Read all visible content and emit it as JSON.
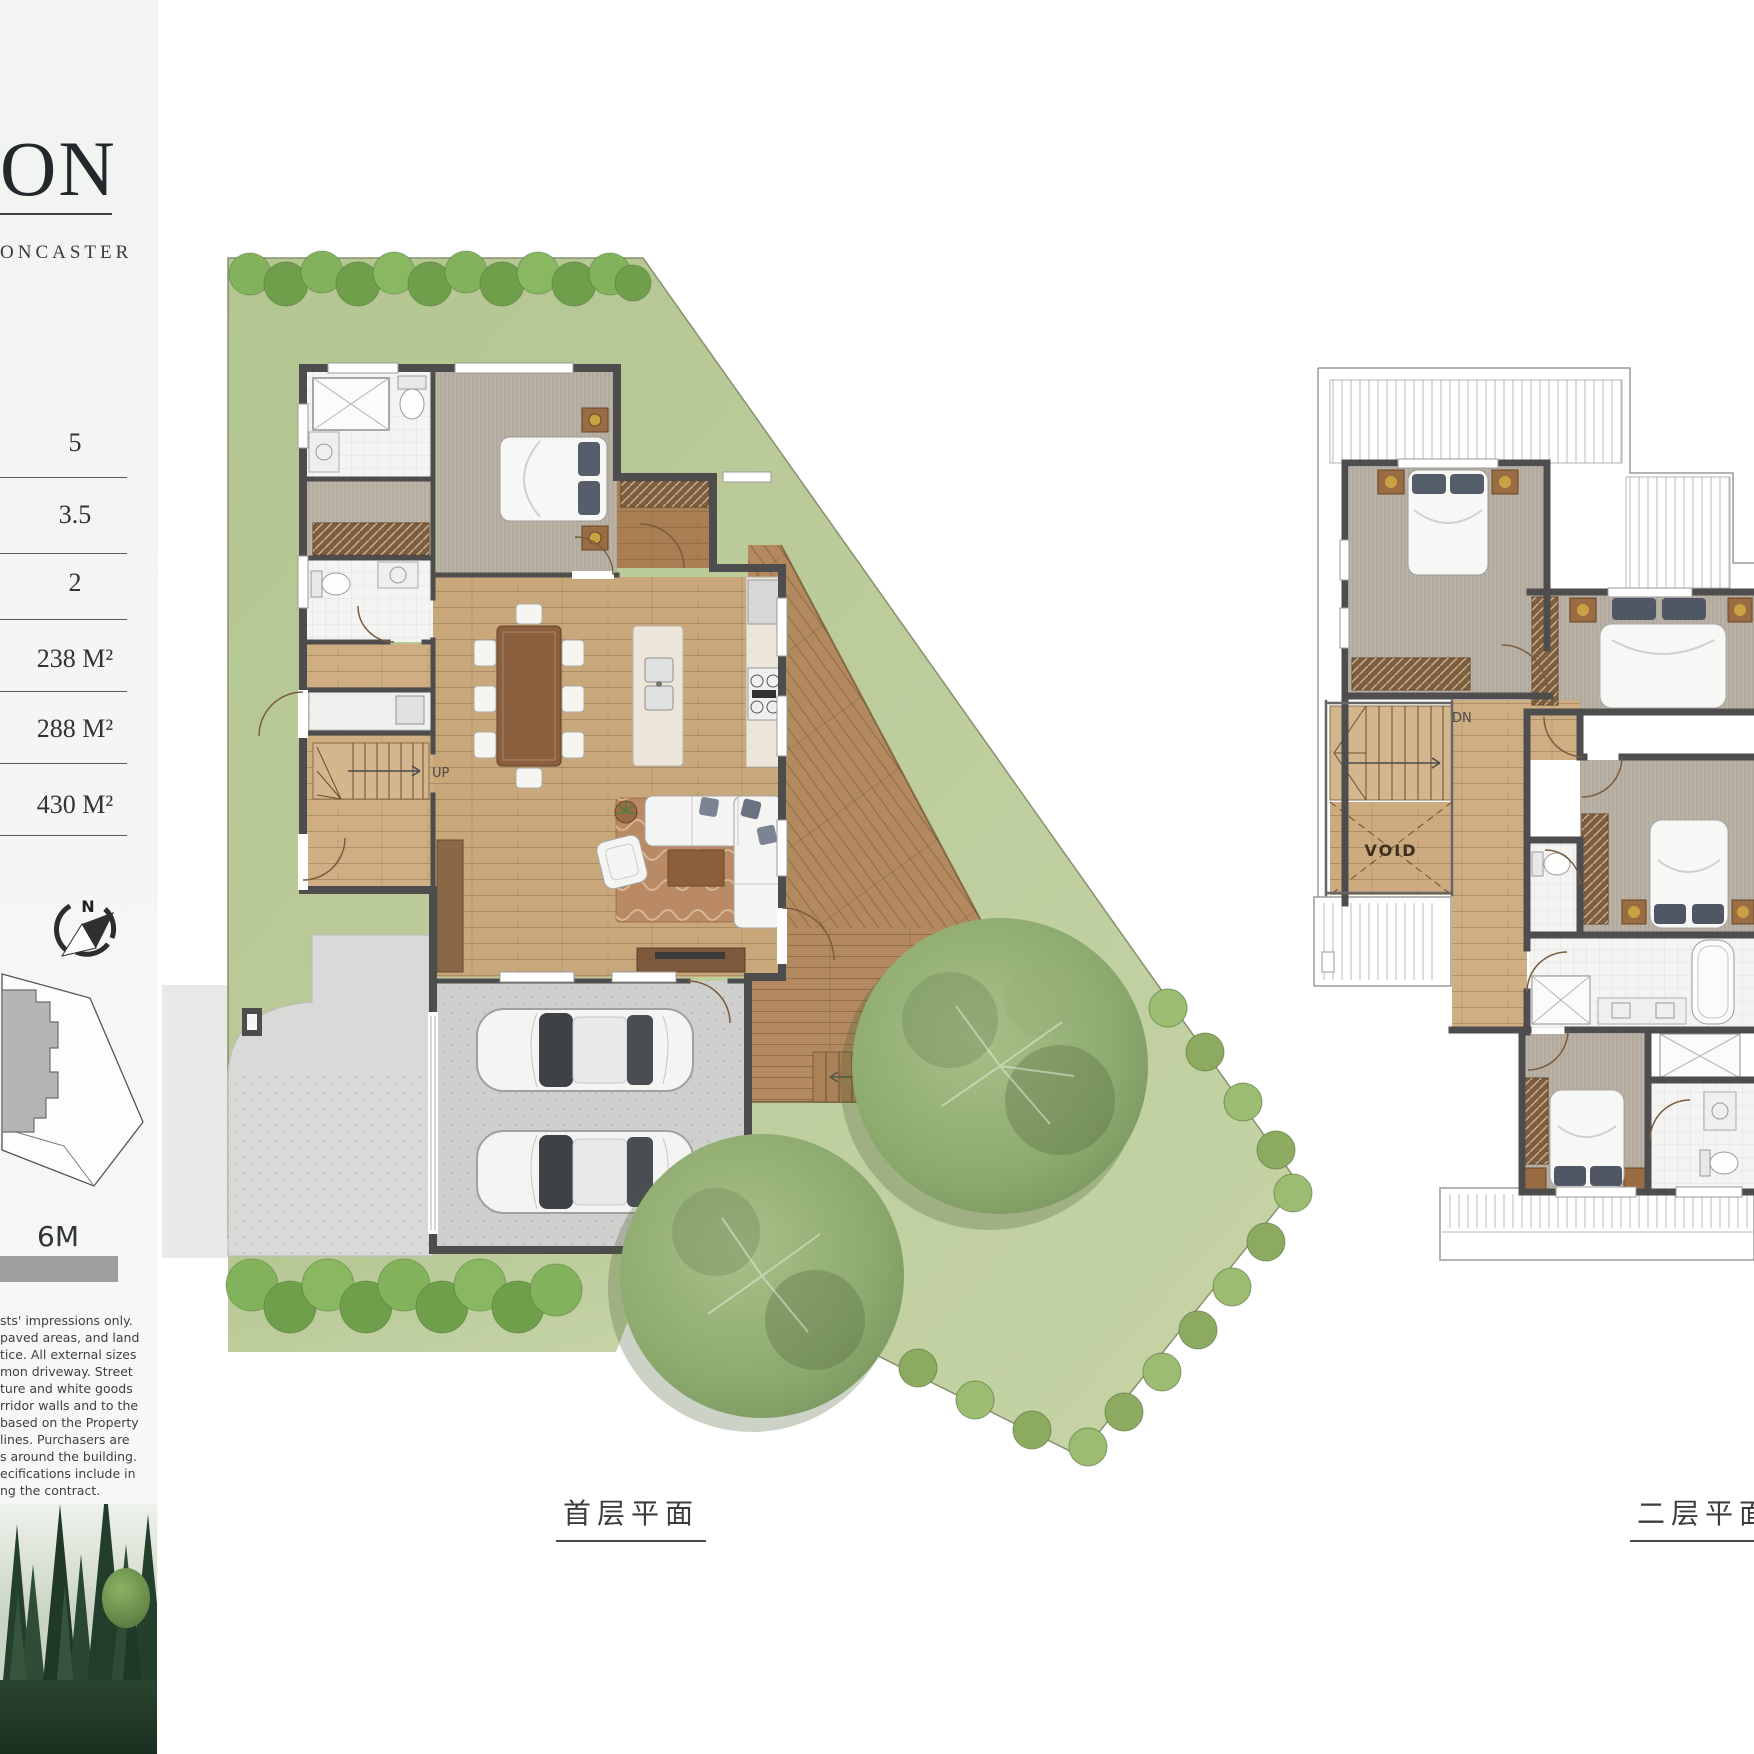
{
  "sidebar": {
    "title_fragment": "ON",
    "subtitle_fragment": "ONCASTER",
    "specs": [
      {
        "value": "5"
      },
      {
        "value": "3.5"
      },
      {
        "value": "2"
      },
      {
        "value": "238 M²"
      },
      {
        "value": "288 M²"
      },
      {
        "value": "430 M²"
      }
    ],
    "compass": {
      "north_label": "N"
    },
    "scale_bar": {
      "label": "6M"
    },
    "disclaimer_lines": [
      "sts' impressions only.",
      "paved areas, and land",
      "tice. All external sizes",
      "mon driveway. Street",
      "ture and white goods",
      "rridor walls and to the",
      "based on the Property",
      "lines. Purchasers are",
      "s around the building.",
      "ecifications include in",
      "ng the contract."
    ]
  },
  "plans": {
    "ground": {
      "caption": "首层平面",
      "labels": {
        "stairs": "UP",
        "deck_stairs": "UP"
      }
    },
    "upper": {
      "caption": "二层平面",
      "labels": {
        "stairs": "DN",
        "void": "VOID"
      }
    }
  },
  "colors": {
    "wall": "#4d4d4d",
    "grass": "#b7c997",
    "grass-light": "#c6d4a8",
    "hedge": "#7dab54",
    "hedge-dark": "#699a47",
    "wood": "#c8a77b",
    "wood-dark": "#8a6747",
    "deck": "#b3895f",
    "carpet": "#bab2a5",
    "tile": "#f4f4f2",
    "concrete": "#cfcfcd",
    "driveway": "#d9d9d7",
    "street": "#e9e9e7",
    "tree": "#8fae72",
    "rug": "#b98a63",
    "text": "#33383c",
    "roof-line": "#9a9a9a"
  }
}
